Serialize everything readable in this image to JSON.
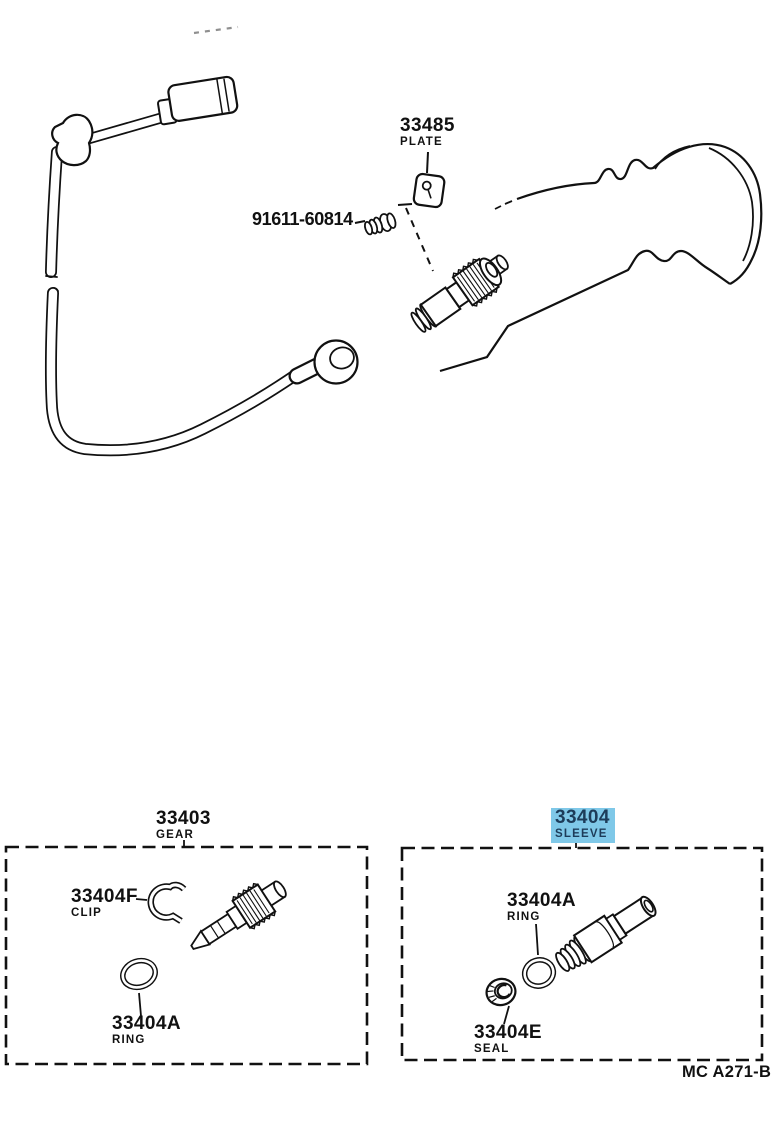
{
  "page": {
    "background": "#ffffff",
    "figure_code": "MC A271-B"
  },
  "colors": {
    "line": "#111111",
    "label_text": "#111111",
    "highlight_bg": "#7fc8e8",
    "highlight_text": "#1d3c59"
  },
  "callouts": {
    "plate": {
      "code": "33485",
      "name": "PLATE"
    },
    "bolt": {
      "code": "91611-60814"
    },
    "gear_kit": {
      "code": "33403",
      "name": "GEAR",
      "highlighted": false
    },
    "sleeve_kit": {
      "code": "33404",
      "name": "SLEEVE",
      "highlighted": true
    },
    "clip": {
      "code": "33404F",
      "name": "CLIP"
    },
    "ring_gear_kit": {
      "code": "33404A",
      "name": "RING"
    },
    "ring_sleeve_kit": {
      "code": "33404A",
      "name": "RING"
    },
    "seal": {
      "code": "33404E",
      "name": "SEAL"
    }
  }
}
